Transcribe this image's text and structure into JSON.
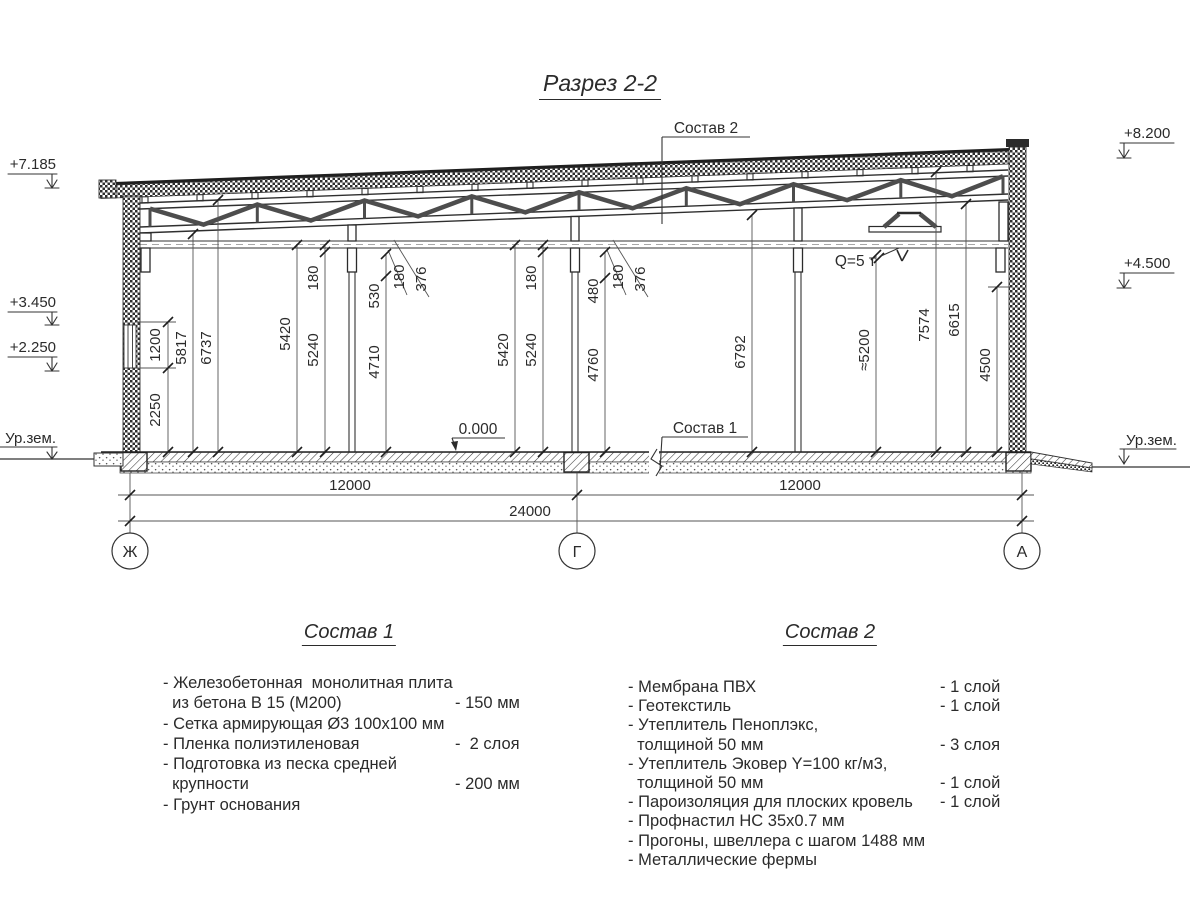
{
  "title": "Разрез 2-2",
  "callouts": {
    "top": "Состав 2",
    "floor": "Состав 1",
    "zero": "0.000",
    "crane": "Q=5 т",
    "ground_left": "Ур.зем.",
    "ground_right": "Ур.зем."
  },
  "elevations": {
    "e7185": "+7.185",
    "e3450": "+3.450",
    "e2250": "+2.250",
    "e8200": "+8.200",
    "e4500": "+4.500"
  },
  "axes": {
    "left": "Ж",
    "middle": "Г",
    "right": "А"
  },
  "dims": {
    "h": {
      "left": "12000",
      "right": "12000",
      "total": "24000"
    },
    "v": {
      "d2250": "2250",
      "d1200": "1200",
      "d5817": "5817",
      "d6737": "6737",
      "dL5420": "5420",
      "dL5240": "5240",
      "dL180": "180",
      "d530": "530",
      "d4710": "4710",
      "dL180b": "180",
      "dL376": "376",
      "dM5420": "5420",
      "dM5240": "5240",
      "dM180": "180",
      "d480": "480",
      "d4760": "4760",
      "dM180b": "180",
      "dM376": "376",
      "d6792": "6792",
      "d5200": "≈5200",
      "d7574": "7574",
      "d6615": "6615",
      "d4500": "4500"
    }
  },
  "composition1": {
    "title": "Состав 1",
    "rows": [
      {
        "t": "- Железобетонная  монолитная плита",
        "v": ""
      },
      {
        "t": "  из бетона В 15 (М200)",
        "v": "- 150 мм"
      },
      {
        "t": "- Сетка армирующая Ø3 100х100 мм",
        "v": ""
      },
      {
        "t": "- Пленка полиэтиленовая",
        "v": "-  2 слоя"
      },
      {
        "t": "- Подготовка из песка средней",
        "v": ""
      },
      {
        "t": "  крупности",
        "v": "- 200 мм"
      },
      {
        "t": "- Грунт основания",
        "v": ""
      }
    ]
  },
  "composition2": {
    "title": "Состав 2",
    "rows": [
      {
        "t": "- Мембрана ПВХ",
        "v": "- 1 слой"
      },
      {
        "t": "- Геотекстиль",
        "v": "- 1 слой"
      },
      {
        "t": "- Утеплитель Пеноплэкс,",
        "v": ""
      },
      {
        "t": "  толщиной 50 мм",
        "v": "- 3 слоя"
      },
      {
        "t": "- Утеплитель Эковер Y=100 кг/м3,",
        "v": ""
      },
      {
        "t": "  толщиной 50 мм",
        "v": "- 1 слой"
      },
      {
        "t": "- Пароизоляция для плоских кровель",
        "v": "- 1 слой"
      },
      {
        "t": "- Профнастил НС 35х0.7 мм",
        "v": ""
      },
      {
        "t": "- Прогоны, швеллера с шагом 1488 мм",
        "v": ""
      },
      {
        "t": "- Металлические фермы",
        "v": ""
      }
    ]
  }
}
